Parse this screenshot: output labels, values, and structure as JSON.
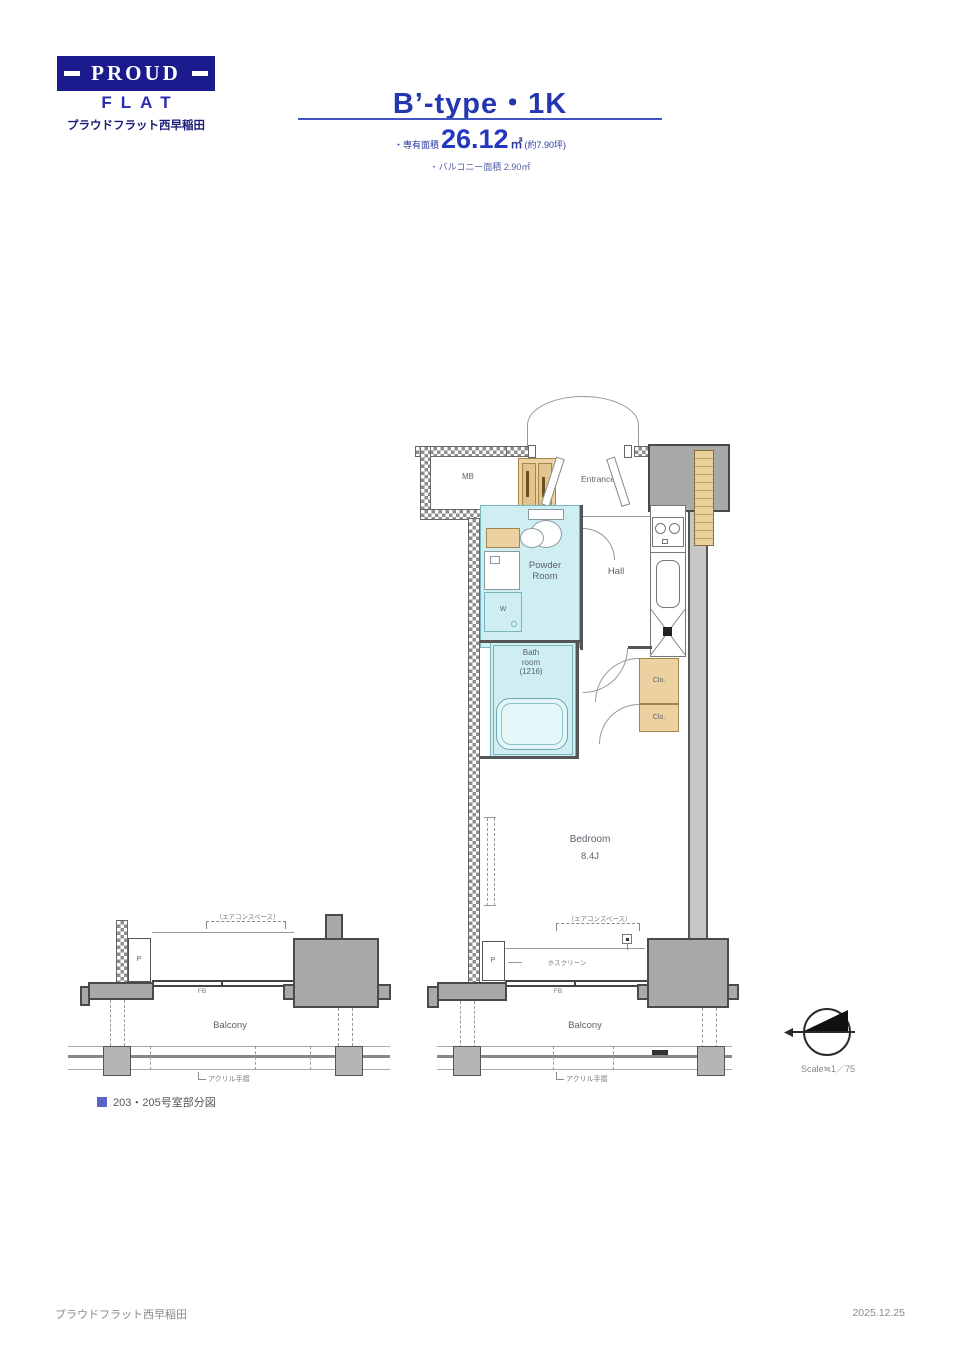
{
  "logo": {
    "proud": "PROUD",
    "flat": "FLAT",
    "property": "プラウドフラット西早稲田"
  },
  "title": {
    "type": "B’-type・1K",
    "area_label": "・専有面積",
    "area_value": "26.12",
    "area_unit": "㎡",
    "area_tsubo": "(約7.90坪)",
    "balcony": "・バルコニー面積 2.90㎡"
  },
  "plan": {
    "entrance": "Entrance",
    "mb": "MB",
    "ps": "PS",
    "powder1": "Powder",
    "powder2": "Room",
    "hall": "Hall",
    "bath1": "Bath",
    "bath2": "room",
    "bath3": "(1216)",
    "w": "W",
    "clo": "Clo.",
    "bedroom": "Bedroom",
    "bedroom_size": "8.4J",
    "balcony": "Balcony",
    "fb": "FB",
    "p": "P",
    "ac_note": "（エアコンスペース）",
    "hos_note": "ホスクリーン",
    "rail_note": "アクリル手摺"
  },
  "partial": {
    "caption": "203・205号室部分図",
    "balcony": "Balcony",
    "fb": "FB",
    "p": "P",
    "ac_note": "（エアコンスペース）",
    "rail_note": "アクリル手摺"
  },
  "compass": {
    "scale": "Scale≒1／75"
  },
  "footer": {
    "left": "プラウドフラット西早稲田",
    "right": "2025.12.25"
  },
  "colors": {
    "brand_navy": "#1b1b8e",
    "brand_blue": "#2a3ab8",
    "room_cyan": "#cfeef2",
    "cabinet_tan": "#ecd2a0",
    "structure_gray": "#a9a9a9",
    "caption_indigo": "#5766c8"
  }
}
